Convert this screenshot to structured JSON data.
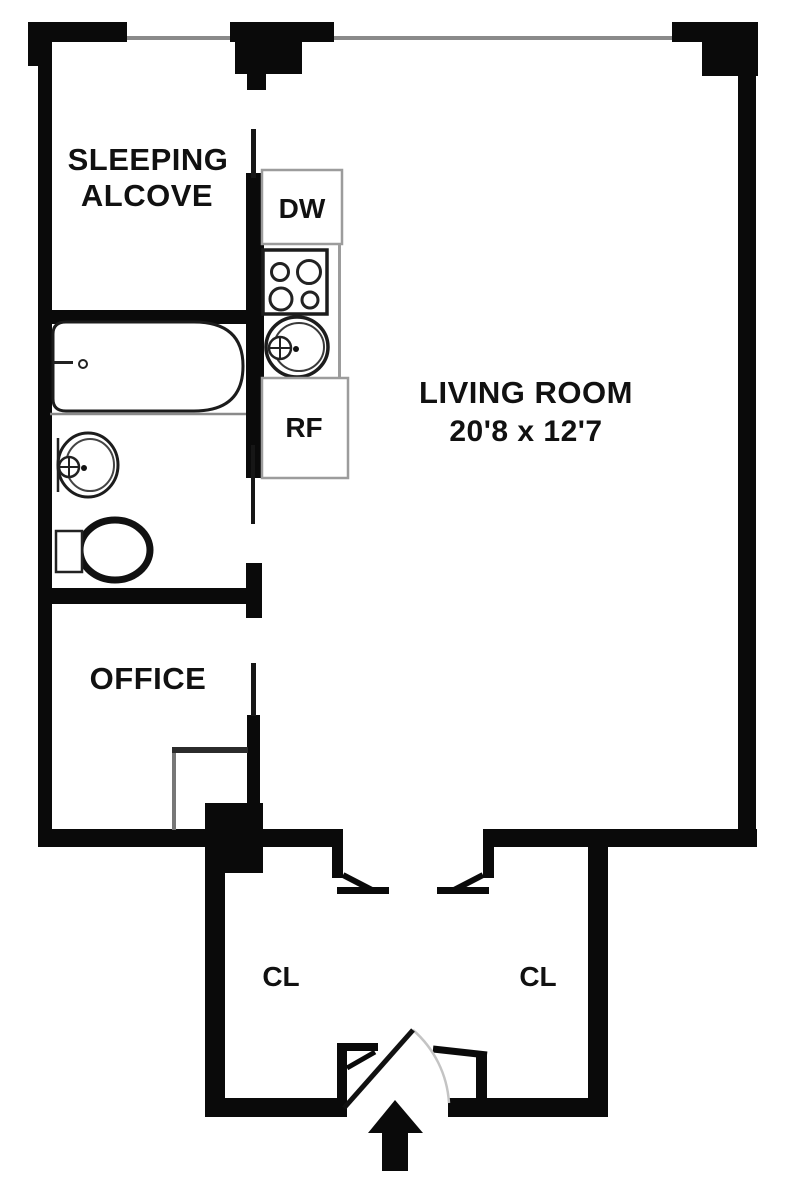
{
  "plan_title": "Studio apartment floor plan",
  "rooms": {
    "sleeping_alcove": {
      "line1": "SLEEPING",
      "line2": "ALCOVE"
    },
    "living_room": {
      "name": "LIVING ROOM",
      "dims": "20'8 x 12'7"
    },
    "office": {
      "name": "OFFICE"
    },
    "closet_left": {
      "name": "CL"
    },
    "closet_right": {
      "name": "CL"
    }
  },
  "appliances": {
    "dishwasher": "DW",
    "refrigerator": "RF"
  },
  "colors": {
    "wall": "#0a0a0a",
    "background": "#ffffff",
    "text": "#111111",
    "appliance_border": "#9c9c9c",
    "window_line": "#8a8a8a",
    "door_swing_arc": "#c4c4c4"
  }
}
